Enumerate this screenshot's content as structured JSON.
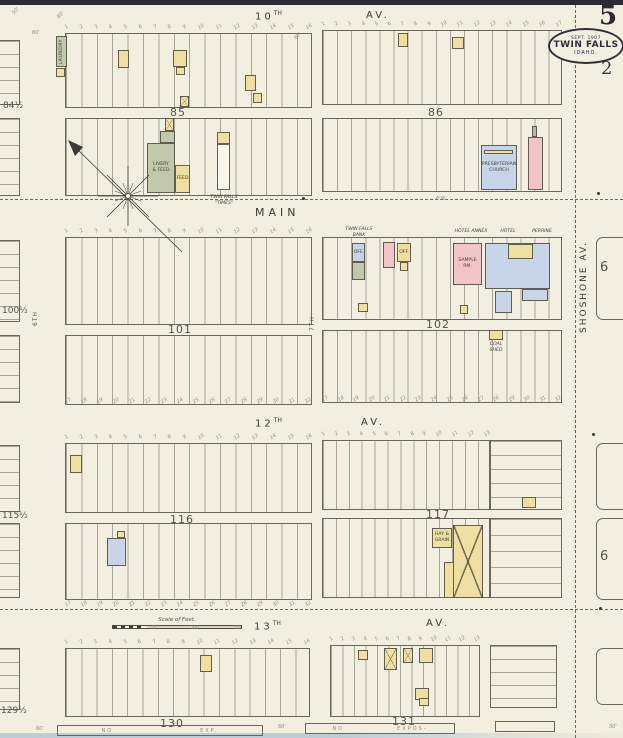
{
  "page": {
    "sheet_number": "5",
    "adjacent_sheet_number": "2",
    "stamp": {
      "date": "SEPT. 1907",
      "city": "TWIN FALLS",
      "state": "IDAHO."
    }
  },
  "colors": {
    "paper": "#f2efe0",
    "ink": "#5f5d51",
    "frame_yellow": "#efdfa0",
    "brick_pink": "#f1c5c8",
    "stone_blue": "#c8d4e7",
    "special_olive": "#c2c8ab",
    "stamp_navy": "#2e2e3c"
  },
  "streets": {
    "tenth": {
      "number": "10",
      "ordinal": "TH",
      "avenue": "AV."
    },
    "main": "MAIN",
    "twelfth": {
      "number": "12",
      "ordinal": "TH",
      "avenue": "AV."
    },
    "thirteenth": {
      "number": "13",
      "ordinal": "TH",
      "avenue": "AV."
    },
    "shoshone": "SHOSHONE   AV.",
    "sixth": "6TH",
    "seventh": "7TH"
  },
  "blocks": {
    "b84": "84½",
    "b85": "85",
    "b86": "86",
    "b100": "100½",
    "b101": "101",
    "b102": "102",
    "b115": "115½",
    "b116": "116",
    "b117": "117",
    "b129": "129½",
    "b130": "130",
    "b131": "131",
    "b6_upper": "6",
    "b6_lower": "6"
  },
  "scale": {
    "title": "Scale of Feet.",
    "ticks": [
      "50",
      "100",
      "150"
    ]
  },
  "bottom_notes": {
    "left": [
      "NO",
      "EXP."
    ],
    "right": [
      "NO",
      "EXPOS-"
    ]
  },
  "lot_numbers": {
    "r16": [
      "1",
      "2",
      "3",
      "4",
      "5",
      "6",
      "7",
      "8",
      "9",
      "10",
      "11",
      "12",
      "13",
      "14",
      "15",
      "16"
    ],
    "r17": [
      "1",
      "2",
      "3",
      "4",
      "5",
      "6",
      "7",
      "8",
      "9",
      "10",
      "11",
      "12",
      "13",
      "14",
      "15",
      "16",
      "17"
    ],
    "r13": [
      "1",
      "2",
      "3",
      "4",
      "5",
      "6",
      "7",
      "8",
      "9",
      "10",
      "11",
      "12",
      "13"
    ],
    "r32": [
      "17",
      "18",
      "19",
      "20",
      "21",
      "22",
      "23",
      "24",
      "25",
      "26",
      "27",
      "28",
      "29",
      "30",
      "31",
      "32"
    ]
  },
  "buildings": [
    {
      "id": "laundry",
      "x": 56,
      "y": 36,
      "w": 11,
      "h": 31,
      "fill": "olive",
      "label": "LAUNDRY",
      "vert": true
    },
    {
      "id": "shed-1",
      "x": 56,
      "y": 68,
      "w": 9,
      "h": 9,
      "fill": "yellow"
    },
    {
      "id": "dwelling-1",
      "x": 118,
      "y": 50,
      "w": 11,
      "h": 18,
      "fill": "yellow"
    },
    {
      "id": "dwelling-2",
      "x": 173,
      "y": 50,
      "w": 14,
      "h": 17,
      "fill": "yellow"
    },
    {
      "id": "shed-2",
      "x": 176,
      "y": 67,
      "w": 9,
      "h": 8,
      "fill": "yellow"
    },
    {
      "id": "dwelling-3",
      "x": 245,
      "y": 75,
      "w": 11,
      "h": 16,
      "fill": "yellow"
    },
    {
      "id": "barn-1",
      "x": 180,
      "y": 96,
      "w": 9,
      "h": 11,
      "fill": "yellow",
      "xmark": true
    },
    {
      "id": "shed-3",
      "x": 253,
      "y": 93,
      "w": 9,
      "h": 10,
      "fill": "yellow"
    },
    {
      "id": "dwelling-4",
      "x": 398,
      "y": 33,
      "w": 10,
      "h": 14,
      "fill": "yellow"
    },
    {
      "id": "dwelling-5",
      "x": 452,
      "y": 37,
      "w": 12,
      "h": 12,
      "fill": "yellow"
    },
    {
      "id": "barn-2",
      "x": 165,
      "y": 118,
      "w": 9,
      "h": 13,
      "fill": "yellow",
      "xmark": true
    },
    {
      "id": "livery-annex",
      "x": 160,
      "y": 131,
      "w": 15,
      "h": 12,
      "fill": "olive"
    },
    {
      "id": "livery-feed",
      "x": 147,
      "y": 143,
      "w": 28,
      "h": 50,
      "fill": "olive",
      "label": "LIVERY\n& FEED"
    },
    {
      "id": "feed-stable",
      "x": 175,
      "y": 165,
      "w": 15,
      "h": 28,
      "fill": "yellow",
      "label": "FEED"
    },
    {
      "id": "times-front",
      "x": 217,
      "y": 132,
      "w": 13,
      "h": 12,
      "fill": "yellow"
    },
    {
      "id": "times-office",
      "x": 217,
      "y": 144,
      "w": 13,
      "h": 46,
      "fill": "white"
    },
    {
      "id": "presbyterian-church",
      "x": 481,
      "y": 145,
      "w": 36,
      "h": 45,
      "fill": "blue",
      "label": "PRESBYTERIAN\nCHURCH"
    },
    {
      "id": "church-porch",
      "x": 484,
      "y": 150,
      "w": 29,
      "h": 4,
      "fill": "yellow"
    },
    {
      "id": "brick-store-1",
      "x": 528,
      "y": 137,
      "w": 15,
      "h": 53,
      "fill": "pink"
    },
    {
      "id": "chimney-1",
      "x": 532,
      "y": 126,
      "w": 5,
      "h": 11,
      "fill": "gray"
    },
    {
      "id": "bank-office",
      "x": 352,
      "y": 243,
      "w": 13,
      "h": 19,
      "fill": "blue",
      "label": "OFF."
    },
    {
      "id": "printing-shop",
      "x": 352,
      "y": 262,
      "w": 13,
      "h": 18,
      "fill": "olive"
    },
    {
      "id": "brick-store-2",
      "x": 383,
      "y": 242,
      "w": 12,
      "h": 26,
      "fill": "pink"
    },
    {
      "id": "office-2",
      "x": 397,
      "y": 243,
      "w": 14,
      "h": 19,
      "fill": "yellow",
      "label": "OFF."
    },
    {
      "id": "shed-4",
      "x": 400,
      "y": 262,
      "w": 8,
      "h": 9,
      "fill": "yellow"
    },
    {
      "id": "sample-room",
      "x": 453,
      "y": 243,
      "w": 29,
      "h": 42,
      "fill": "pink",
      "label": "SAMPLE\nRM."
    },
    {
      "id": "hotel-perrine-main",
      "x": 485,
      "y": 243,
      "w": 65,
      "h": 46,
      "fill": "blue"
    },
    {
      "id": "hotel-courtyard",
      "x": 508,
      "y": 244,
      "w": 25,
      "h": 15,
      "fill": "yellow"
    },
    {
      "id": "hotel-wing-1",
      "x": 522,
      "y": 289,
      "w": 26,
      "h": 12,
      "fill": "blue"
    },
    {
      "id": "hotel-wing-2",
      "x": 495,
      "y": 291,
      "w": 17,
      "h": 22,
      "fill": "blue"
    },
    {
      "id": "shed-5",
      "x": 460,
      "y": 305,
      "w": 8,
      "h": 9,
      "fill": "yellow"
    },
    {
      "id": "coal-house",
      "x": 358,
      "y": 303,
      "w": 10,
      "h": 9,
      "fill": "yellow"
    },
    {
      "id": "coal-shed",
      "x": 489,
      "y": 330,
      "w": 14,
      "h": 10,
      "fill": "yellow"
    },
    {
      "id": "dwelling-6",
      "x": 70,
      "y": 455,
      "w": 12,
      "h": 18,
      "fill": "yellow"
    },
    {
      "id": "dwelling-7",
      "x": 107,
      "y": 538,
      "w": 19,
      "h": 28,
      "fill": "blue"
    },
    {
      "id": "shed-6",
      "x": 117,
      "y": 531,
      "w": 8,
      "h": 7,
      "fill": "yellow"
    },
    {
      "id": "dwelling-8",
      "x": 522,
      "y": 497,
      "w": 14,
      "h": 11,
      "fill": "yellow"
    },
    {
      "id": "hay-grain",
      "x": 432,
      "y": 528,
      "w": 20,
      "h": 20,
      "fill": "yellow",
      "label": "HAY &\nGRAIN"
    },
    {
      "id": "livery-barn",
      "x": 453,
      "y": 525,
      "w": 30,
      "h": 73,
      "fill": "yellow",
      "xmark": true
    },
    {
      "id": "implement-shed",
      "x": 444,
      "y": 562,
      "w": 10,
      "h": 36,
      "fill": "yellow"
    },
    {
      "id": "dwelling-9",
      "x": 200,
      "y": 655,
      "w": 12,
      "h": 17,
      "fill": "yellow"
    },
    {
      "id": "shed-7",
      "x": 358,
      "y": 650,
      "w": 10,
      "h": 10,
      "fill": "yellow"
    },
    {
      "id": "barn-3",
      "x": 384,
      "y": 648,
      "w": 13,
      "h": 22,
      "fill": "yellow",
      "xmark": true
    },
    {
      "id": "barn-4",
      "x": 403,
      "y": 648,
      "w": 10,
      "h": 15,
      "fill": "yellow",
      "xmark": true
    },
    {
      "id": "dwelling-10",
      "x": 419,
      "y": 648,
      "w": 14,
      "h": 15,
      "fill": "yellow"
    },
    {
      "id": "shed-8",
      "x": 415,
      "y": 688,
      "w": 14,
      "h": 12,
      "fill": "yellow"
    },
    {
      "id": "shed-9",
      "x": 419,
      "y": 698,
      "w": 10,
      "h": 8,
      "fill": "yellow"
    }
  ],
  "floating_labels": [
    {
      "t": "TWIN FALLS\n\"TIMES\"",
      "x": 205,
      "y": 195,
      "w": 38
    },
    {
      "t": "TWIN FALLS\nBANK",
      "x": 344,
      "y": 227,
      "w": 30
    },
    {
      "t": "HOTEL ANNEX",
      "x": 450,
      "y": 229,
      "w": 42
    },
    {
      "t": "HOTEL",
      "x": 496,
      "y": 229,
      "w": 24
    },
    {
      "t": "PERRINE",
      "x": 526,
      "y": 229,
      "w": 32
    },
    {
      "t": "COAL SHED",
      "x": 483,
      "y": 342,
      "w": 26
    }
  ],
  "dim_marks": [
    {
      "t": "50'",
      "x": 12,
      "y": 8,
      "r": -50
    },
    {
      "t": "80'",
      "x": 57,
      "y": 12,
      "r": -50
    },
    {
      "t": "60'",
      "x": 32,
      "y": 30,
      "r": 0
    },
    {
      "t": "60'",
      "x": 294,
      "y": 33,
      "r": -50
    },
    {
      "t": "6'W.",
      "x": 436,
      "y": 196,
      "r": 0
    },
    {
      "t": "60'",
      "x": 36,
      "y": 726,
      "r": 0
    },
    {
      "t": "60'",
      "x": 278,
      "y": 724,
      "r": 0
    },
    {
      "t": "50'",
      "x": 609,
      "y": 724,
      "r": 0
    }
  ],
  "dots": [
    {
      "x": 597,
      "y": 192
    },
    {
      "x": 302,
      "y": 197
    },
    {
      "x": 592,
      "y": 433
    },
    {
      "x": 599,
      "y": 607
    }
  ]
}
